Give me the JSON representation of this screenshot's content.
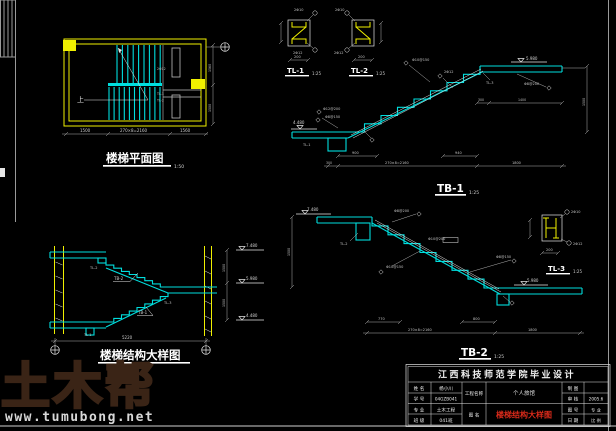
{
  "colors": {
    "background": "#000000",
    "line_cyan": "#00dede",
    "line_yellow": "#f0f000",
    "line_white": "#e6e6e6",
    "dim_gray": "#b0b0b0",
    "red_text": "#d92a1a",
    "watermark_brown": "#3a2416"
  },
  "watermark": {
    "logo_text": "土木帮",
    "site_url": "www.tumubong.net"
  },
  "plan": {
    "title": "楼梯平面图",
    "scale": "1:50",
    "up_label": "上",
    "dim_left": "1500",
    "dim_mid": "270×8=2160",
    "dim_right": "1560",
    "dim_side_top": "1560",
    "dim_side_bottom": "1500",
    "tag_a": "TL-1",
    "tag_b": "TL-2",
    "tag_c": "2Φ12"
  },
  "tl1": {
    "label": "TL-1",
    "scale": "1:25",
    "bar_top": "2Φ10",
    "bar_bottom": "2Φ12",
    "dim": "200"
  },
  "tl2": {
    "label": "TL-2",
    "scale": "1:25",
    "bar_top": "2Φ10",
    "bar_bottom": "2Φ12",
    "dim": "200"
  },
  "tl3": {
    "label": "TL-3",
    "scale": "1:25",
    "bar_top": "2Φ10",
    "bar_bottom": "2Φ12",
    "dim": "200"
  },
  "tb1": {
    "label": "TB-1",
    "scale": "1:25",
    "level_left": "4.480",
    "level_top": "5.980",
    "callout_1": "Φ10@150",
    "callout_2": "2Φ12",
    "callout_3": "Φ8@200",
    "callout_4": "TL-3",
    "callout_5": "Φ8@150",
    "callout_6": "Φ12@200",
    "callout_7": "TL-1",
    "dim_top_a": "300",
    "dim_top_b": "1400",
    "dim_sub_a": "900",
    "dim_sub_b": "940",
    "dim_a": "300",
    "dim_b": "270×8=2160",
    "dim_c": "1800",
    "dim_side": "1500"
  },
  "tb2": {
    "label": "TB-2",
    "scale": "1:25",
    "level_left": "7.480",
    "level_right": "5.980",
    "callout_1": "Φ8@200",
    "callout_2": "Φ10@200",
    "callout_3": "Φ10@150",
    "callout_4": "Φ8@150",
    "callout_5": "TL-2",
    "dim_sub_a": "770",
    "dim_sub_b": "800",
    "dim_a": "270×8=2160",
    "dim_b": "1800",
    "dim_side": "1500"
  },
  "section": {
    "title": "楼梯结构大样图",
    "level_top": "7.480",
    "level_mid": "5.980",
    "level_bottom": "4.480",
    "dim_side_a": "1500",
    "dim_side_b": "1500",
    "dim_total": "5220",
    "tag_tb1": "TB-1",
    "tag_tb2": "TB-2",
    "tag_tl1": "TL-1",
    "tag_tl2": "TL-2",
    "tag_tl3": "TL-3"
  },
  "titleblock": {
    "school": "江西科技师范学院毕业设计",
    "rows": [
      {
        "label": "姓 名",
        "value": "杨小川"
      },
      {
        "label": "学 号",
        "value": "04GZB041"
      },
      {
        "label": "专 业",
        "value": "土木工程"
      },
      {
        "label": "班 级",
        "value": "041班"
      }
    ],
    "project_label": "工程名称",
    "project_name": "个人旅馆",
    "drawing_label": "图 名",
    "drawing_name": "楼梯结构大样图",
    "right_rows": [
      {
        "label": "制 图"
      },
      {
        "label": "审 核"
      },
      {
        "label": "图 号"
      },
      {
        "label": "日 期"
      }
    ],
    "far_rows": [
      "",
      "2005.6",
      "专 业",
      "比 例"
    ]
  }
}
